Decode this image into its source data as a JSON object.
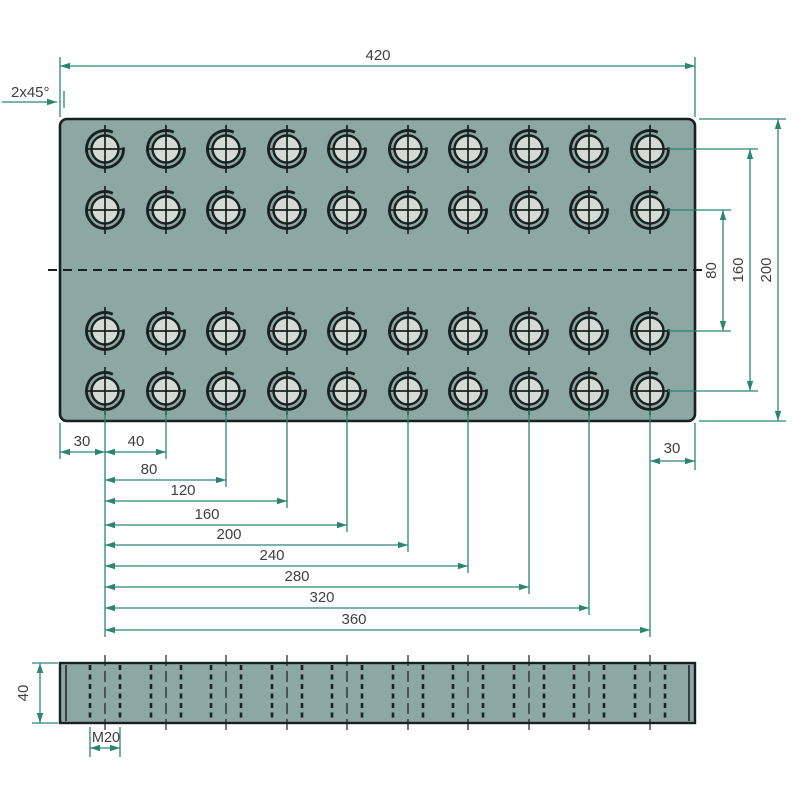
{
  "drawing": {
    "kind": "technical-drawing",
    "subject": "rectangular plate with 4x10 M20 threaded holes, top view and side view",
    "colors": {
      "background": "#ffffff",
      "plate_fill": "#8da7a2",
      "hole_fill": "#d4dad6",
      "outline": "#18211f",
      "dimension": "#2a8673",
      "text": "#3f3f3f"
    },
    "top_view": {
      "plate": {
        "x": 60,
        "y": 119,
        "w": 635,
        "h": 302,
        "corner_radius": 7
      },
      "hole_columns_x": [
        105,
        166,
        226,
        287,
        347,
        408,
        468,
        529,
        589,
        650
      ],
      "hole_rows_y": [
        149,
        210,
        331,
        391
      ],
      "hole_inner_r": 13.5,
      "hole_outer_r": 18.5,
      "centerline": {
        "x1": 48,
        "y": 270,
        "x2": 707
      }
    },
    "side_view": {
      "plate": {
        "x": 60,
        "y": 663,
        "w": 635,
        "h": 60
      },
      "chamfer_inset": 6,
      "thread_half_width": 15,
      "hole_columns_x": [
        105,
        166,
        226,
        287,
        347,
        408,
        468,
        529,
        589,
        650
      ]
    },
    "labels": {
      "overall_width": "420",
      "chamfer": "2x45°",
      "row_pitch": "80",
      "row_span": "160",
      "overall_height": "200",
      "thickness": "40",
      "thread": "M20"
    },
    "dims": {
      "top": {
        "label": "420",
        "x1": 60,
        "x2": 695,
        "y": 66,
        "ext": [
          [
            60,
            57,
            117
          ],
          [
            695,
            57,
            117
          ]
        ],
        "tx": 378,
        "ty": 60
      },
      "chamfer": {
        "label": "2x45°",
        "tx": 11,
        "ty": 97,
        "leader": [
          2,
          102,
          57,
          102
        ],
        "tick": [
          64,
          91,
          64,
          108
        ]
      },
      "right": [
        {
          "label": "80",
          "x": 723,
          "y1": 210,
          "y2": 331
        },
        {
          "label": "160",
          "x": 750,
          "y1": 149,
          "y2": 391
        },
        {
          "label": "200",
          "x": 778,
          "y1": 119,
          "y2": 421
        }
      ],
      "right_ext": [
        [
          668,
          149,
          758
        ],
        [
          668,
          210,
          731
        ],
        [
          668,
          331,
          731
        ],
        [
          668,
          391,
          758
        ],
        [
          699,
          119,
          786
        ],
        [
          699,
          421,
          786
        ]
      ],
      "bottom": [
        {
          "label": "30",
          "x1": 60,
          "x2": 105,
          "y": 452,
          "tx": 82,
          "ty": 446
        },
        {
          "label": "40",
          "x1": 105,
          "x2": 166,
          "y": 452,
          "tx": 136,
          "ty": 446
        },
        {
          "label": "80",
          "x1": 105,
          "x2": 226,
          "y": 480,
          "tx": 149,
          "ty": 474
        },
        {
          "label": "120",
          "x1": 105,
          "x2": 287,
          "y": 501,
          "tx": 183,
          "ty": 495
        },
        {
          "label": "160",
          "x1": 105,
          "x2": 347,
          "y": 525,
          "tx": 207,
          "ty": 519
        },
        {
          "label": "200",
          "x1": 105,
          "x2": 408,
          "y": 545,
          "tx": 229,
          "ty": 539
        },
        {
          "label": "240",
          "x1": 105,
          "x2": 468,
          "y": 566,
          "tx": 272,
          "ty": 560
        },
        {
          "label": "280",
          "x1": 105,
          "x2": 529,
          "y": 587,
          "tx": 297,
          "ty": 581
        },
        {
          "label": "320",
          "x1": 105,
          "x2": 589,
          "y": 608,
          "tx": 322,
          "ty": 602
        },
        {
          "label": "360",
          "x1": 105,
          "x2": 650,
          "y": 630,
          "tx": 354,
          "ty": 624
        },
        {
          "label": "30",
          "x1": 650,
          "x2": 695,
          "y": 461,
          "tx": 672,
          "ty": 453
        }
      ],
      "bottom_ext": [
        [
          60,
          423,
          459
        ],
        [
          105,
          410,
          637
        ],
        [
          166,
          410,
          459
        ],
        [
          226,
          410,
          487
        ],
        [
          287,
          410,
          508
        ],
        [
          347,
          410,
          532
        ],
        [
          408,
          410,
          552
        ],
        [
          468,
          410,
          573
        ],
        [
          529,
          410,
          594
        ],
        [
          589,
          410,
          615
        ],
        [
          650,
          410,
          637
        ],
        [
          695,
          423,
          470
        ]
      ],
      "side_thickness": {
        "label": "40",
        "x": 40,
        "y1": 663,
        "y2": 723,
        "ext": [
          [
            58,
            663,
            32
          ],
          [
            58,
            723,
            32
          ]
        ],
        "tx": 28,
        "ty": 694
      },
      "side_thread": {
        "label": "M20",
        "x1": 90,
        "x2": 120,
        "y": 748,
        "ext": [
          [
            90,
            727,
            757
          ],
          [
            120,
            727,
            757
          ]
        ],
        "tx": 106,
        "ty": 742
      }
    }
  }
}
